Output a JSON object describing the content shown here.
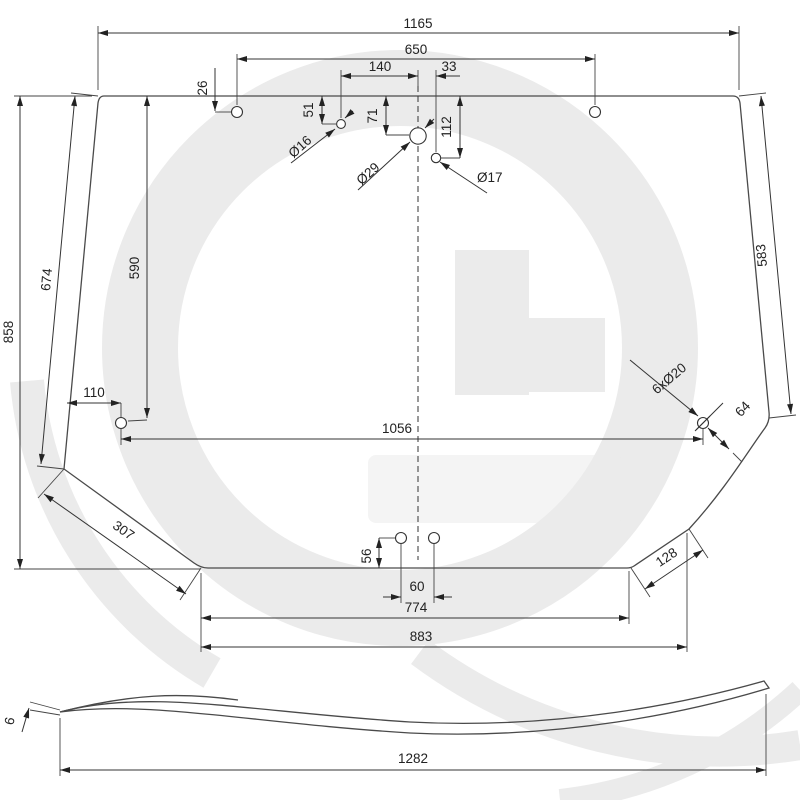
{
  "drawing": {
    "kind": "glass pane technical drawing",
    "colors": {
      "glass_tint": "#cde5f5",
      "line": "#333333",
      "watermark_gray": "#ebebeb"
    }
  },
  "main_view": {
    "overall_width": "1165",
    "top_hole_span": "650",
    "center_spacing_16_29": "140",
    "center_spacing_29_17": "33",
    "top_left_hole_depth": "26",
    "hole16_depth": "51",
    "hole29_depth": "71",
    "hole17_depth": "112",
    "hole16_dia": "Ø16",
    "hole29_dia": "Ø29",
    "hole17_dia": "Ø17",
    "left_edge_length": "674",
    "overall_height": "858",
    "side_hole_depth": "590",
    "side_hole_inset": "110",
    "right_edge_length": "583",
    "side_hole_span": "1056",
    "mount_holes_callout": "6xØ20",
    "notch_hole_offset": "64",
    "lower_left_edge": "307",
    "bottom_hole_depth": "56",
    "bottom_hole_spacing": "60",
    "bottom_edge_length": "774",
    "bottom_span": "883",
    "lower_right_edge": "128"
  },
  "profile_view": {
    "glass_thickness": "6",
    "overall_width": "1282"
  }
}
